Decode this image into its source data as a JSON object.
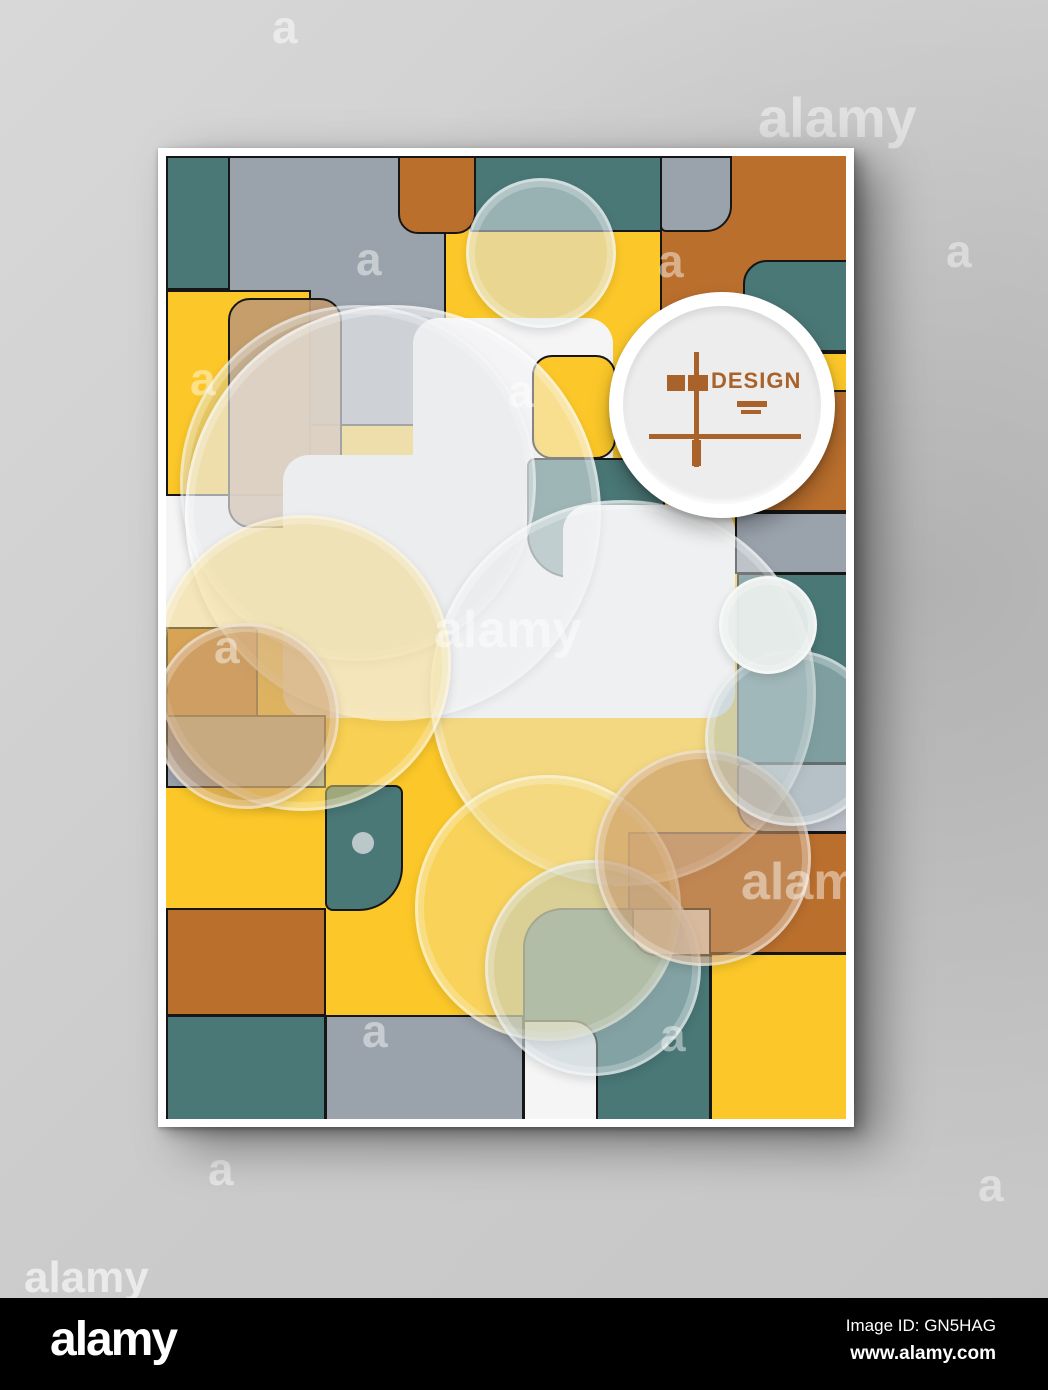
{
  "page": {
    "watermarks": [
      {
        "t": "a",
        "x": 272,
        "y": 4,
        "s": 46,
        "o": 0.5
      },
      {
        "t": "alamy",
        "x": 758,
        "y": 90,
        "s": 56,
        "o": 0.45
      },
      {
        "t": "a",
        "x": 946,
        "y": 228,
        "s": 46,
        "o": 0.42
      },
      {
        "t": "a",
        "x": 208,
        "y": 1146,
        "s": 46,
        "o": 0.5
      },
      {
        "t": "a",
        "x": 978,
        "y": 1162,
        "s": 46,
        "o": 0.42
      },
      {
        "t": "alamy",
        "x": 24,
        "y": 1256,
        "s": 44,
        "o": 0.6
      }
    ]
  },
  "poster": {
    "brand": {
      "title": "DESIGN",
      "accent": "#a8622a"
    },
    "palette": {
      "yellow": "#FCC829",
      "teal": "#4A7877",
      "orange": "#BA6F2D",
      "gray": "#9AA2AC",
      "lightgray": "#B9BEC6",
      "white": "#F5F5F6",
      "tan": "#C09A72"
    },
    "shapes": [
      {
        "name": "teal-top-left",
        "x": 0,
        "y": 0,
        "w": 64,
        "h": 134,
        "c": "teal",
        "b": true
      },
      {
        "name": "gray-top-left",
        "x": 62,
        "y": 0,
        "w": 218,
        "h": 270,
        "c": "gray",
        "b": true
      },
      {
        "name": "orange-right-big",
        "x": 494,
        "y": -6,
        "w": 192,
        "h": 246,
        "c": "orange",
        "b": true
      },
      {
        "name": "orange-right-mid",
        "x": 559,
        "y": 229,
        "w": 127,
        "h": 127,
        "c": "orange",
        "b": true
      },
      {
        "name": "teal-top-mid",
        "x": 304,
        "y": 0,
        "w": 192,
        "h": 76,
        "c": "teal",
        "b": true
      },
      {
        "name": "orange-top-small",
        "x": 232,
        "y": 0,
        "w": 78,
        "h": 78,
        "c": "orange",
        "b": true,
        "r": "0 0 20px 20px"
      },
      {
        "name": "gray-top-rounded",
        "x": 494,
        "y": 0,
        "w": 72,
        "h": 76,
        "c": "gray",
        "b": true,
        "r": "0 0 26px 6px"
      },
      {
        "name": "teal-right-rounded",
        "x": 577,
        "y": 104,
        "w": 109,
        "h": 92,
        "c": "teal",
        "b": true,
        "r": "24px 0 0 24px"
      },
      {
        "name": "yellow-right-strip",
        "x": 642,
        "y": 196,
        "w": 44,
        "h": 40,
        "c": "yellow",
        "b": true
      },
      {
        "name": "yellow-left-column",
        "x": 0,
        "y": 134,
        "w": 145,
        "h": 206,
        "c": "yellow",
        "b": true,
        "r": "0 0 34px 0"
      },
      {
        "name": "white-left-block",
        "x": 0,
        "y": 340,
        "w": 118,
        "h": 131,
        "c": "white",
        "b": false
      },
      {
        "name": "tan-rounded",
        "x": 62,
        "y": 142,
        "w": 114,
        "h": 230,
        "c": "rgba(192,154,114,0.92)",
        "b": true,
        "r": "22px"
      },
      {
        "name": "white-cross-a",
        "x": 247,
        "y": 162,
        "w": 200,
        "h": 202,
        "c": "white",
        "r": "26px"
      },
      {
        "name": "white-cross-b",
        "x": 117,
        "y": 299,
        "w": 330,
        "h": 263,
        "c": "white",
        "r": "26px"
      },
      {
        "name": "yellow-center-rounded",
        "x": 366,
        "y": 199,
        "w": 84,
        "h": 104,
        "c": "yellow",
        "b": true,
        "r": "20px"
      },
      {
        "name": "teal-center",
        "x": 361,
        "y": 302,
        "w": 138,
        "h": 120,
        "c": "teal",
        "b": true,
        "r": "8px 8px 18px 44px"
      },
      {
        "name": "white-cross-c",
        "x": 397,
        "y": 349,
        "w": 172,
        "h": 213,
        "c": "white",
        "r": "26px"
      },
      {
        "name": "orange-left",
        "x": 0,
        "y": 471,
        "w": 92,
        "h": 90,
        "c": "orange",
        "b": true
      },
      {
        "name": "gray-left",
        "x": 0,
        "y": 559,
        "w": 160,
        "h": 73,
        "c": "gray",
        "b": true
      },
      {
        "name": "teal-small-rounded",
        "x": 159,
        "y": 629,
        "w": 78,
        "h": 126,
        "c": "teal",
        "b": true,
        "r": "8px 8px 44px 8px"
      },
      {
        "name": "orange-left-2",
        "x": 0,
        "y": 752,
        "w": 160,
        "h": 108,
        "c": "orange",
        "b": true
      },
      {
        "name": "teal-left-3",
        "x": 0,
        "y": 859,
        "w": 160,
        "h": 110,
        "c": "teal",
        "b": true
      },
      {
        "name": "gray-bottom",
        "x": 159,
        "y": 859,
        "w": 199,
        "h": 110,
        "c": "gray",
        "b": true
      },
      {
        "name": "orange-bottom-right",
        "x": 462,
        "y": 676,
        "w": 224,
        "h": 122,
        "c": "orange",
        "b": true
      },
      {
        "name": "gray-right",
        "x": 569,
        "y": 356,
        "w": 117,
        "h": 62,
        "c": "gray",
        "b": true
      },
      {
        "name": "teal-right",
        "x": 571,
        "y": 417,
        "w": 115,
        "h": 191,
        "c": "teal",
        "b": true
      },
      {
        "name": "gray-right-rounded",
        "x": 571,
        "y": 607,
        "w": 115,
        "h": 70,
        "c": "lightgray",
        "b": true,
        "r": "6px 6px 6px 28px"
      },
      {
        "name": "teal-bottom-rounded",
        "x": 357,
        "y": 752,
        "w": 188,
        "h": 217,
        "c": "teal",
        "b": true,
        "r": "40px 8px 0 0"
      },
      {
        "name": "white-notch",
        "x": 466,
        "y": 752,
        "w": 79,
        "h": 48,
        "c": "#f3f0e8",
        "b": true,
        "r": "0 0 0 24px"
      },
      {
        "name": "white-bottom",
        "x": 357,
        "y": 864,
        "w": 75,
        "h": 105,
        "c": "white",
        "b": true,
        "r": "0 26px 0 0"
      },
      {
        "name": "yellow-bottom-right",
        "x": 544,
        "y": 797,
        "w": 142,
        "h": 172,
        "c": "yellow",
        "b": true
      }
    ],
    "circles": [
      {
        "name": "top-translucent",
        "cx": 372,
        "cy": 94,
        "r": 72,
        "c": "rgba(216,226,229,0.55)",
        "ring": true
      },
      {
        "name": "gray-top-left-halo",
        "cx": 189,
        "cy": 324,
        "r": 175,
        "c": "rgba(196,202,210,0.35)",
        "ring": true
      },
      {
        "name": "white-big",
        "cx": 224,
        "cy": 354,
        "r": 205,
        "c": "rgba(244,244,246,0.5)",
        "ring": true
      },
      {
        "name": "white-mid",
        "cx": 454,
        "cy": 534,
        "r": 190,
        "c": "rgba(232,234,238,0.45)",
        "ring": true
      },
      {
        "name": "yellow-left",
        "cx": 134,
        "cy": 504,
        "r": 145,
        "c": "rgba(243,215,125,0.5)",
        "ring": true
      },
      {
        "name": "tan-left",
        "cx": 77,
        "cy": 557,
        "r": 90,
        "c": "rgba(199,155,111,0.55)",
        "ring": true
      },
      {
        "name": "yellow-bottom",
        "cx": 379,
        "cy": 749,
        "r": 130,
        "c": "rgba(244,219,129,0.55)",
        "ring": true
      },
      {
        "name": "blue-bottom",
        "cx": 424,
        "cy": 809,
        "r": 105,
        "c": "rgba(187,203,207,0.5)",
        "ring": true
      },
      {
        "name": "tan-right",
        "cx": 534,
        "cy": 699,
        "r": 105,
        "c": "rgba(198,152,108,0.6)",
        "ring": true
      },
      {
        "name": "gray-right",
        "cx": 624,
        "cy": 579,
        "r": 85,
        "c": "rgba(178,196,199,0.5)",
        "ring": true
      },
      {
        "name": "small-white",
        "cx": 599,
        "cy": 466,
        "r": 46,
        "c": "rgba(233,238,236,0.95)",
        "ring": true
      },
      {
        "name": "teal-dot",
        "cx": 197,
        "cy": 687,
        "r": 11,
        "c": "rgba(198,208,210,0.9)"
      }
    ],
    "watermarks": [
      {
        "t": "a",
        "x": 190,
        "y": 80,
        "s": 46
      },
      {
        "t": "a",
        "x": 492,
        "y": 82,
        "s": 46
      },
      {
        "t": "a",
        "x": 24,
        "y": 200,
        "s": 46
      },
      {
        "t": "a",
        "x": 342,
        "y": 212,
        "s": 46
      },
      {
        "t": "alamy",
        "x": 268,
        "y": 448,
        "s": 52
      },
      {
        "t": "a",
        "x": 48,
        "y": 468,
        "s": 46
      },
      {
        "t": "alamy",
        "x": 575,
        "y": 700,
        "s": 52
      },
      {
        "t": "a",
        "x": 196,
        "y": 852,
        "s": 46
      },
      {
        "t": "a",
        "x": 494,
        "y": 856,
        "s": 46
      }
    ]
  },
  "footer": {
    "logo": "alamy",
    "image_id": "Image ID: GN5HAG",
    "website": "www.alamy.com"
  }
}
